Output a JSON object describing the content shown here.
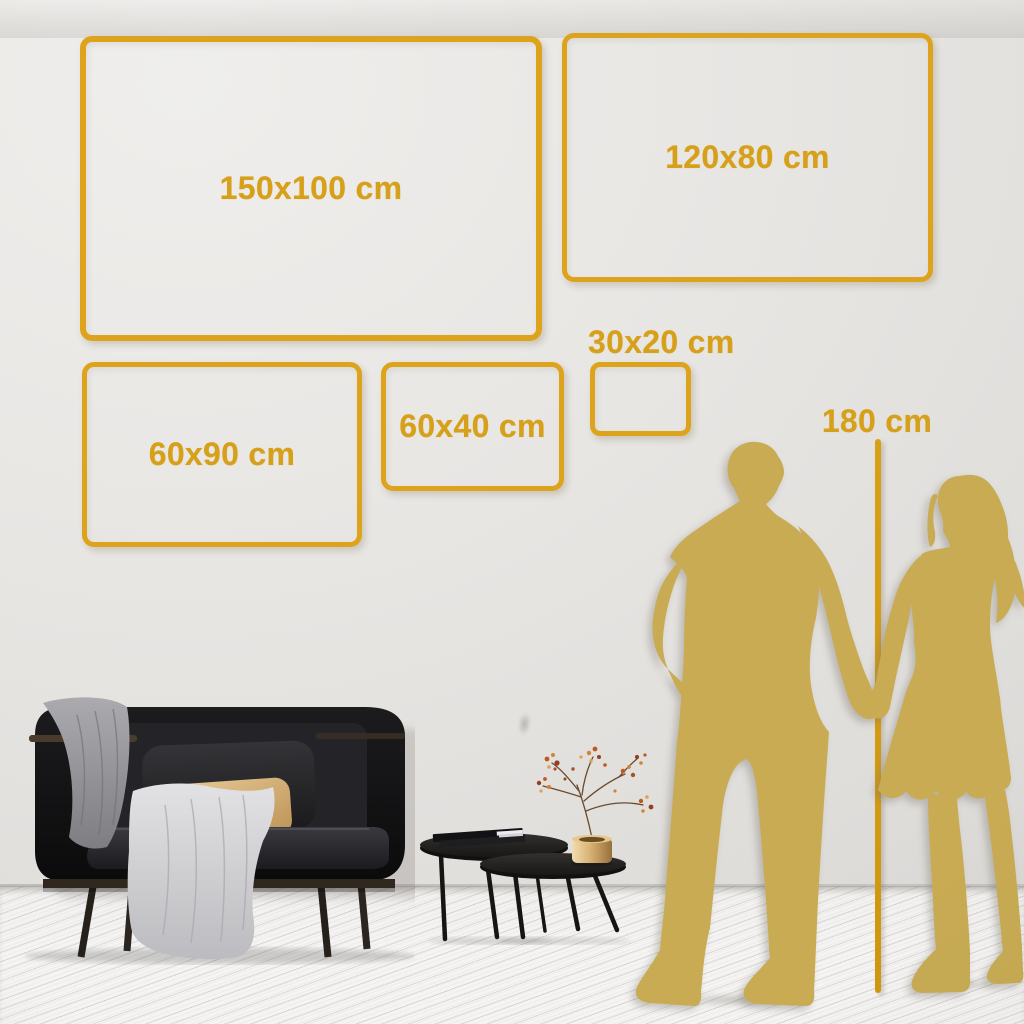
{
  "frames": [
    {
      "name": "frame-150x100",
      "label": "150x100 cm"
    },
    {
      "name": "frame-120x80",
      "label": "120x80 cm"
    },
    {
      "name": "frame-60x90",
      "label": "60x90 cm"
    },
    {
      "name": "frame-60x40",
      "label": "60x40 cm"
    },
    {
      "name": "frame-30x20",
      "label": "30x20 cm"
    }
  ],
  "height_reference": {
    "label": "180 cm"
  },
  "colors": {
    "frame_gold": "#DEA31C",
    "label_gold": "#D7A01A",
    "measure_line_gold": "#D49B12",
    "silhouette_gold": "#C8AB53",
    "wall_light": "#EFEEEC",
    "wall_dark": "#D6D4D1",
    "floor": "#F3F2F1"
  },
  "scene": {
    "silhouettes": [
      "man-silhouette",
      "woman-silhouette"
    ],
    "furniture": [
      "sofa",
      "coffee-tables",
      "brass-vase-with-branch"
    ]
  }
}
